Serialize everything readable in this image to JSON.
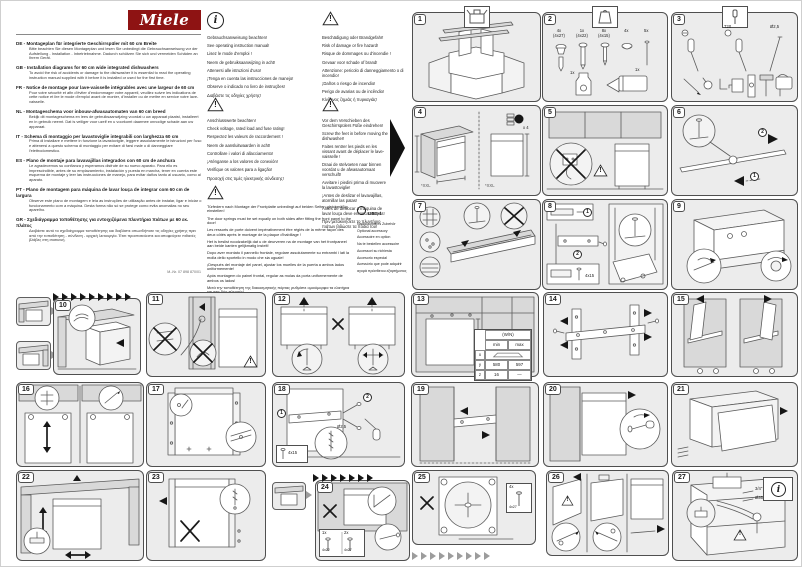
{
  "page": {
    "brand": "Miele",
    "mnr": "M.-Nr. 07 898 870/01"
  },
  "icons": {
    "info_mark": "i",
    "warning_mark": "!"
  },
  "languages": [
    {
      "full": "DE - Montageplan für integrierte Geschirrspüler mit 60 cm Breite",
      "body": "Bitte beachten Sie diesen Montageplan und lesen Sie unbedingt die Gebrauchsanweisung vor der Aufstellung - Installation - Inbetriebnahme. Dadurch schützen Sie sich und vermeiden Schäden an Ihrem Gerät."
    },
    {
      "full": "GB - Installation diagrams for 60 cm wide integrated dishwashers",
      "body": "To avoid the risk of accidents or damage to the dishwasher it is essential to read the operating instruction manual supplied with it before it is installed or used for the first time."
    },
    {
      "full": "FR - Notice de montage pour lave-vaisselle intégrables avec une largeur de 60 cm",
      "body": "Pour votre sécurité et afin d'éviter d'endommager votre appareil, veuillez suivre les indications de cette notice et lire le mode d'emploi avant de monter, d'installer ou de mettre en service votre lave-vaisselle."
    },
    {
      "full": "NL - Montageschema voor inbouw-afwasautomaten van 60 cm breed",
      "body": "Bekijk dit montageschema en lees de gebruiksaanwijzing voordat u uw apparaat plaatst, installeert en in gebruik neemt. Dat is veiliger voor uzelf en u voorkomt daarmee onnodige schade aan uw apparaat."
    },
    {
      "full": "IT - Schema di montaggio per lavastoviglie integrabili con larghezza 60 cm",
      "body": "Prima di installare e mettere in funzione la lavastoviglie, leggere assolutamente le istruzioni per l'uso e attenersi a questo schema di montaggio per evitare di farsi male o di danneggiare l'elettrodomestico."
    },
    {
      "full": "ES - Plano de montaje para lavavajillas integrados con 60 cm de anchura",
      "body": "Le agradecemos su confianza y esperamos disfrute de su nuevo aparato. Para ello es imprescindible, antes de su emplazamiento, instalación y puesta en marcha, tener en cuenta este esquema de montaje y leer las instrucciones de manejo, para evitar daños tanto al usuario, como al aparato."
    },
    {
      "full": "PT - Plano de montagem para máquina de lavar louça de integrar com 60 cm de largura",
      "body": "Observe este plano de montagem e leia as instruções de utilização antes de instalar, ligar e iniciar o funcionamento com a máquina. Desta forma não só se protege como evita anomalias no seu aparelho."
    },
    {
      "full": "GR - Σχεδιάγραμμα τοποθέτησης για εντοιχιζόμενα πλυντήρια πιάτων με 60 εκ. πλάτος",
      "body": "Διαβάστε αυτό το σχεδιάγραμμα τοποθέτησης και διαβάστε οπωσδήποτε τις οδηγίες χρήσης πριν από την τοποθέτηση - σύνδεση - αρχική λειτουργία. Έτσι προστατεύεστε και αποφεύγετε πιθανές βλάβες στη συσκευή."
    }
  ],
  "notices": {
    "manual": {
      "lines": [
        "Gebrauchsanweisung beachten!",
        "See operating instruction manual!",
        "Lisez le mode d'emploi !",
        "Neem de gebruiksaanwijzing in acht!",
        "Attenersi alle istruzioni d'uso!",
        "¡Tenga en cuenta las instrucciones de manejo!",
        "Observe o indicado no livro de instruções!",
        "Διαβάστε τις οδηγίες χρήσης!"
      ]
    },
    "damage": {
      "lines": [
        "Beschädigung oder Brandgefahr!",
        "Risk of damage or fire hazard!",
        "Risque de dommages ou d'incendie !",
        "Gevaar voor schade of brand!",
        "Attenzione: pericolo di danneggiamento o di incendio!",
        "¡Daños o riesgo de incendio!",
        "Perigo de avarias ou de incêndio!",
        "Κίνδυνος ζημιάς ή πυρκαγιάς!"
      ]
    },
    "connection": {
      "lines": [
        "Anschlusswerte beachten!",
        "Check voltage, rated load and fuse rating!",
        "Respectez les valeurs de raccordement !",
        "Neem de aansluitwaarden in acht!",
        "Controllare i valori di allacciamento!",
        "¡Aténganse a los valores de conexión!",
        "Verifique os valores para a ligação!",
        "Προσοχή στις τιμές ηλεκτρικής σύνδεσης!"
      ]
    },
    "feet": {
      "lines": [
        "Vor dem Verschieben des Geschirrspülers Füße eindrehen!",
        "Screw the feet in before moving the dishwasher!",
        "Faites rentrer les pieds en les vissant avant de déplacer le lave-vaisselle !",
        "Draai de stelvoeten naar binnen voordat u de afwasautomaat verschuift!",
        "Avvitare i piedini prima di muovere la lavastoviglie!",
        "¡Antes de deslizar el lavavajillas, atornillar las patas!",
        "Antes de deslocar a máquina de lavar louça deve enroscar os pés!",
        "Πριν μετακινήσετε το πλυντήριο πιάτων βιδώστε τα πόδια του!"
      ]
    },
    "springs": {
      "lines": [
        "Türfedern nach Montage der Frontplatte unbedingt auf beiden Seiten gleichmäßig einstellen!",
        "The door springs must be set equally on both sides after fitting the front panel to the door!",
        "Les ressorts de porte doivent impérativement être réglés de la même façon des deux côtés après le montage de la plaque d'habillage !",
        "Het is beslist noodzakelijk dat u de deurveren na de montage van het frontpaneel aan beide kanten gelijkmatig instelt!",
        "Dopo aver montato il pannello frontale, regolare assolutamente su entrambi i lati la molla dello sportello in modo che sia uguale!",
        "¡Después del montaje del panel, ajustar los muelles de la puerta a ambos lados uniformemente!",
        "Após montagem do painel frontal, regular as molas da porta uniformemente de ambos os lados!",
        "Μετά την τοποθέτηση της διακοσμητικής πόρτας ρυθμίστε ομοιόμορφα τα ελατήρια και στις δύο πλευρές!"
      ]
    },
    "accessory": {
      "badge": "UBS-1",
      "lines": [
        "Nachkaufbares Zubehör",
        "Optional accessory",
        "Accessoire en option",
        "Na te bestellen accessoire",
        "Accessori su richiesta",
        "Accesorio especial",
        "Acessório que pode adquirir",
        "αγορά πρόσθετου εξαρτήματος"
      ]
    }
  },
  "panels": [
    {
      "num": "1"
    },
    {
      "num": "2",
      "labels": [
        "4x\n(4x27)",
        "1x\n(4x22)",
        "8x\n(4x15)",
        "4x",
        "5x",
        "1x",
        "1x"
      ]
    },
    {
      "num": "3",
      "labels": [
        "T20",
        "Ø2,5"
      ]
    },
    {
      "num": "4",
      "labels": [
        "x 4",
        "*XXL",
        "*XXL"
      ]
    },
    {
      "num": "5"
    },
    {
      "num": "6",
      "labels": [
        "1",
        "2"
      ]
    },
    {
      "num": "7"
    },
    {
      "num": "8",
      "labels": [
        "1",
        "2",
        "4x15"
      ]
    },
    {
      "num": "9"
    },
    {
      "num": "10"
    },
    {
      "num": "11"
    },
    {
      "num": "12"
    },
    {
      "num": "13",
      "table": {
        "title": "(W/N)",
        "c1": "min",
        "c2": "max",
        "r1": "x",
        "r2": "y",
        "r3": "z",
        "y1": "580",
        "y2": "597",
        "z1": "16",
        "z2": "—"
      }
    },
    {
      "num": "14"
    },
    {
      "num": "15"
    },
    {
      "num": "16"
    },
    {
      "num": "17"
    },
    {
      "num": "18",
      "labels": [
        "1",
        "2",
        "Ø2,5",
        "4x15"
      ]
    },
    {
      "num": "19"
    },
    {
      "num": "20"
    },
    {
      "num": "21"
    },
    {
      "num": "22"
    },
    {
      "num": "23"
    },
    {
      "num": "24",
      "labels": [
        "1x",
        "4x22",
        "2x",
        "4x27"
      ]
    },
    {
      "num": "25",
      "labels": [
        "4x",
        "4x27"
      ]
    },
    {
      "num": "26"
    },
    {
      "num": "27",
      "labels": [
        "3/4\"",
        "Ø35 mm"
      ]
    }
  ]
}
